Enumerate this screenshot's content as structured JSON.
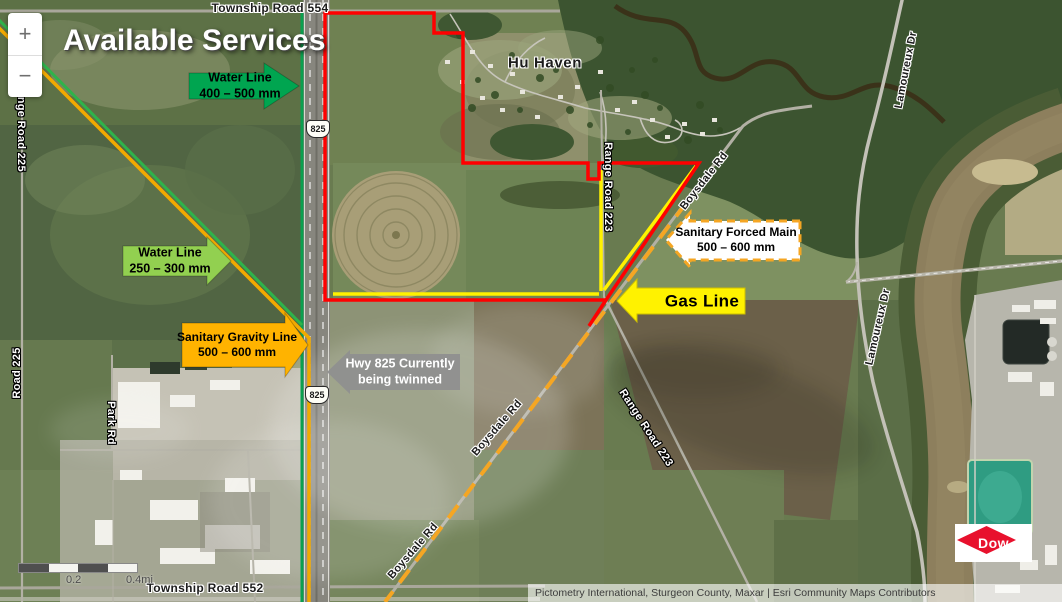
{
  "title": "Available Services",
  "zoom_control": {
    "zoom_in_label": "+",
    "zoom_out_label": "−"
  },
  "place_labels": {
    "hu_haven": "Hu Haven"
  },
  "road_labels": {
    "township_road_554": "Township Road 554",
    "township_road_552": "Township Road 552",
    "range_road_225_a": "Range Road 225",
    "range_road_225_b": "Road 225",
    "range_road_223_a": "Range Road 223",
    "range_road_223_b": "Range Road 223",
    "park_rd": "Park Rd",
    "boysdale_rd_a": "Boysdale Rd",
    "boysdale_rd_b": "Boysdale Rd",
    "boysdale_rd_c": "Boysdale Rd",
    "lamoureux_dr_a": "Lamoureux Dr",
    "lamoureux_dr_b": "Lamoureux Dr"
  },
  "highway_shields": {
    "a": "825",
    "b": "825"
  },
  "annotations": {
    "water_line_large": {
      "line1": "Water Line",
      "line2": "400 – 500 mm",
      "arrow_color": "#00A550",
      "text_color": "#000000",
      "direction": "right"
    },
    "water_line_small": {
      "line1": "Water Line",
      "line2": "250 – 300 mm",
      "arrow_color": "#92D050",
      "text_color": "#000000",
      "direction": "right"
    },
    "sanitary_gravity": {
      "line1": "Sanitary Gravity Line",
      "line2": "500 – 600 mm",
      "arrow_color": "#FFB300",
      "text_color": "#000000",
      "direction": "right"
    },
    "hwy_825_twinning": {
      "line1": "Hwy 825 Currently",
      "line2": "being twinned",
      "arrow_color": "#8F8F8F",
      "text_color": "#FFFFFF",
      "direction": "left"
    },
    "sanitary_forced_main": {
      "line1": "Sanitary Forced Main",
      "line2": "500 – 600 mm",
      "arrow_color": "#FFFFFF",
      "arrow_border_color": "#F5A623",
      "text_color": "#000000",
      "direction": "left"
    },
    "gas_line": {
      "label": "Gas Line",
      "arrow_color": "#FFF200",
      "text_color": "#000000",
      "direction": "left"
    }
  },
  "service_line_colors": {
    "water_line": "#0AA04F",
    "water_line_diagonal": "#2EB34B",
    "sanitary_gravity": "#F2A900",
    "gas_line": "#FFF200",
    "sanitary_forced_main_dashed": "#F5A623",
    "boundary_red": "#FF0000"
  },
  "scale_bar": {
    "mid_label": "0.2",
    "end_label": "0.4mi"
  },
  "attribution": "Pictometry International, Sturgeon County, Maxar | Esri Community Maps Contributors",
  "logo": {
    "text": "Dow",
    "diamond_color": "#E8112D"
  }
}
